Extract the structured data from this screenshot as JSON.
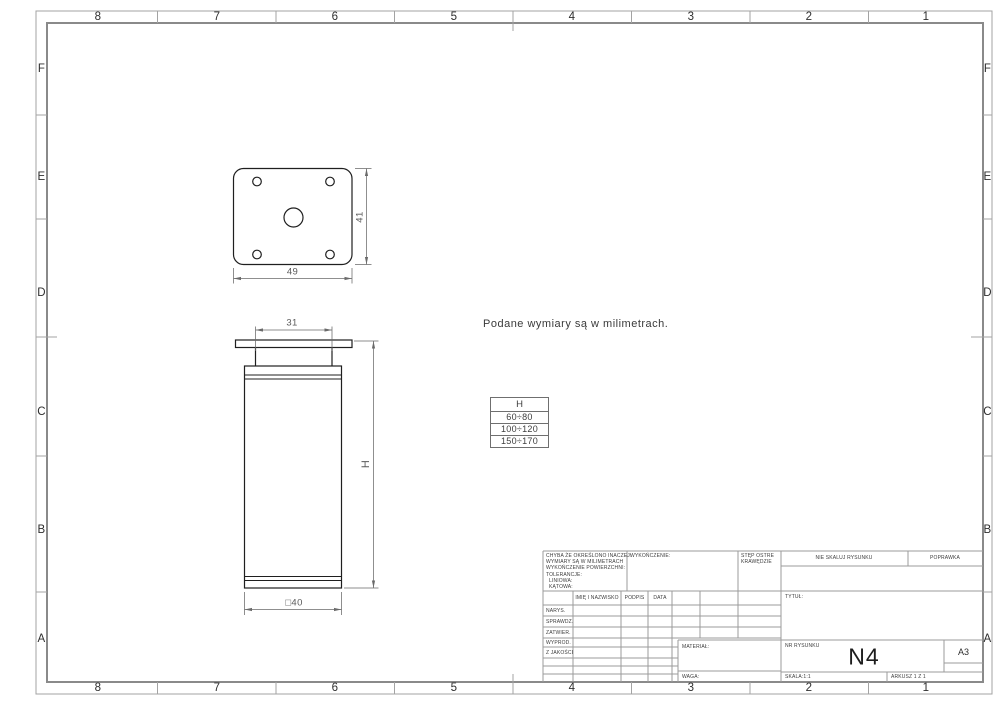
{
  "sheet": {
    "zone_numbers": [
      "8",
      "7",
      "6",
      "5",
      "4",
      "3",
      "2",
      "1"
    ],
    "zone_letters": [
      "F",
      "E",
      "D",
      "C",
      "B",
      "A"
    ]
  },
  "note": {
    "units": "Podane wymiary są w milimetrach."
  },
  "h_table": {
    "header": "H",
    "rows": [
      "60÷80",
      "100÷120",
      "150÷170"
    ]
  },
  "dimensions": {
    "plate_width": "49",
    "plate_depth": "41",
    "neck_width": "31",
    "leg_height": "H",
    "leg_width": "□40"
  },
  "title_block": {
    "tolerance_notes": [
      "CHYBA ŻE OKREŚLONO INACZEJ:",
      "WYMIARY SĄ W MILIMETRACH",
      "WYKOŃCZENIE POWIERZCHNI:",
      "TOLERANCJE:",
      "LINIOWA:",
      "KĄTOWA:"
    ],
    "finish_label": "WYKOŃCZENIE:",
    "deburr_label": "STĘP OSTRE KRAWĘDZIE",
    "no_scale_label": "NIE SKALUJ RYSUNKU",
    "revision_label": "POPRAWKA",
    "name_header": "IMIĘ I NAZWISKO",
    "signature_header": "PODPIS",
    "date_header": "DATA",
    "approval_rows": [
      "NARYS.",
      "SPRAWDZ.",
      "ZATWIER.",
      "WYPROD.",
      "Z JAKOŚCI"
    ],
    "title_label": "TYTUŁ:",
    "material_label": "MATERIAŁ:",
    "weight_label": "WAGA:",
    "drawing_number_label": "NR RYSUNKU",
    "drawing_number": "N4",
    "paper_size": "A3",
    "scale": "SKALA:1:1",
    "sheet_count": "ARKUSZ 1 Z 1"
  }
}
